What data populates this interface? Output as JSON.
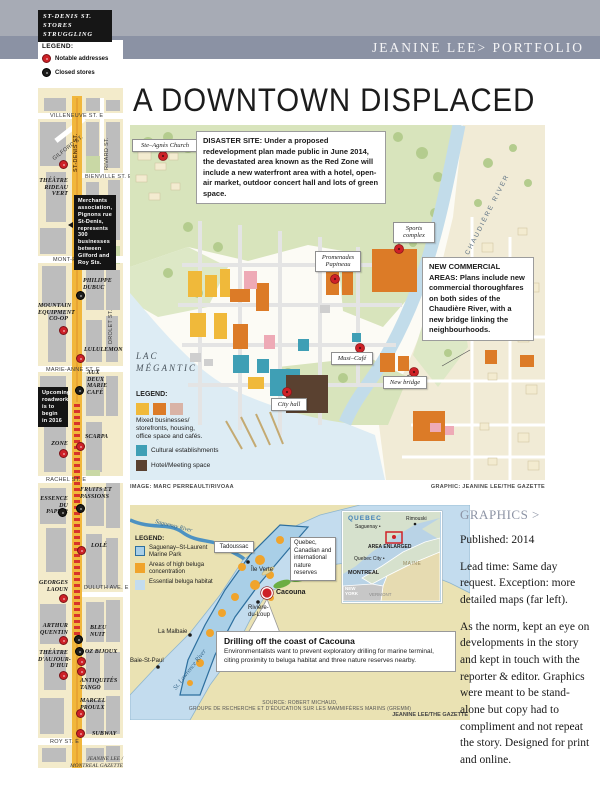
{
  "header": {
    "portfolio_label": "JEANINE LEE> PORTFOLIO",
    "page_title": "A DOWNTOWN DISPLACED"
  },
  "sidebar": {
    "title": "ST-DENIS ST.\nSTORES\nSTRUGGLING",
    "legend": {
      "heading": "LEGEND:",
      "notable": "Notable addresses",
      "closed": "Closed stores",
      "notable_color": "#ce2127",
      "closed_color": "#1d1d1b"
    },
    "streets": {
      "villeneuve": "VILLENEUVE ST. E",
      "gilford": "GILFORD ST.",
      "stdenis": "ST-DENIS ST.",
      "rivard": "RIVARD ST.",
      "bienville": "BIENVILLE ST. E",
      "montroyal": "MONT-ROYAL AVE. E",
      "drolet": "DROLET ST.",
      "marieanne": "MARIE-ANNE ST. E",
      "rachel": "RACHEL ST. E",
      "duluth": "DULUTH AVE. E",
      "roy": "ROY ST. E"
    },
    "notes": {
      "merchants": "Merchants association, Pignons rue St-Denis, represents 300 businesses between Gilford and Roy Sts.",
      "roadwork": "Upcoming roadwork is to begin in 2016"
    },
    "stores": [
      {
        "label": "THÉÂTRE\nRIDEAU\nVERT",
        "type": "red"
      },
      {
        "label": "PHILIPPE\nDUBUC",
        "type": "black"
      },
      {
        "label": "MOUNTAIN\nEQUIPMENT\nCO-OP",
        "type": "red"
      },
      {
        "label": "LULULEMON",
        "type": "red"
      },
      {
        "label": "AUX\nDEUX\nMARIE\nCAFÉ",
        "type": "black"
      },
      {
        "label": "SCARPA",
        "type": "red"
      },
      {
        "label": "ZONE",
        "type": "red"
      },
      {
        "label": "FRUITS ET\nPASSIONS",
        "type": "black"
      },
      {
        "label": "ESSENCE\nDU PAPIER",
        "type": "black"
      },
      {
        "label": "LOLÉ",
        "type": "red"
      },
      {
        "label": "GEORGES\nLAOUN",
        "type": "red"
      },
      {
        "label": "ARTHUR\nQUENTIN",
        "type": "red"
      },
      {
        "label": "BLEU\nNUIT",
        "type": "black"
      },
      {
        "label": "OZ BIJOUX",
        "type": "black"
      },
      {
        "label": "L'EXPRESS",
        "type": "red"
      },
      {
        "label": "THÉÂTRE\nD'AUJOUR-\nD'HUI",
        "type": "red"
      },
      {
        "label": "ANTIQUITÉS\nTANGO",
        "type": "red"
      },
      {
        "label": "MARCEL\nPROULX",
        "type": "red"
      },
      {
        "label": "SUBWAY",
        "type": "red"
      }
    ],
    "credit": "JEANINE LEE /\nMONTREAL GAZETTE"
  },
  "main_map": {
    "callouts": {
      "disaster": "DISASTER SITE: Under a proposed redevelopment plan made public in June 2014, the devastated area known as the Red Zone will include a new waterfront area with a hotel, open-air market, outdoor concert hall and lots of green space.",
      "commercial": "NEW COMMERCIAL AREAS: Plans include new commercial thoroughfares on both sides of the Chaudière River, with a new bridge linking the neighbourhoods."
    },
    "labels": {
      "church": "Ste–Agnès Church",
      "sports": "Sports\ncomplex",
      "promenades": "Promenades\nPapineau",
      "musicafe": "Musi–Café",
      "newbridge": "New bridge",
      "cityhall": "City hall",
      "river": "CHAUDIÈRE RIVER",
      "lake": "LAC\nMÉGANTIC"
    },
    "legend": {
      "heading": "LEGEND:",
      "mixed": "Mixed businesses/\nstorefronts, housing,\noffice space and cafés.",
      "cultural": "Cultural establishments",
      "hotel": "Hotel/Meeting space",
      "yellow": "#f0b93a",
      "orange": "#dc7b27",
      "pink": "#d9b3a6",
      "teal": "#3f9fb5",
      "brown": "#5a4130"
    },
    "credit_image": "IMAGE: MARC PERREAULT/RIVOAA",
    "credit_graphic": "GRAPHIC: JEANINE LEE/THE GAZETTE"
  },
  "small_map": {
    "legend": {
      "heading": "LEGEND:",
      "park": "Saguenay–St-Laurent\nMarine Park",
      "beluga": "Areas of high beluga concentration",
      "habitat": "Essential beluga habitat",
      "park_color": "#a9cfe7",
      "beluga_color": "#f0a42c",
      "habitat_color": "#c3dcee"
    },
    "labels": {
      "saguenay_river": "Saguenay River",
      "tadoussac": "Tadoussac",
      "ile_verte": "Île Verte",
      "cacouna": "Cacouna",
      "riviere_du_loup": "Rivière-\ndu-Loup",
      "la_malbaie": "La Malbaie",
      "baie_st_paul": "Baie-St-Paul",
      "kamouraska": "Kamouraska",
      "st_lawrence": "St. Lawrence River"
    },
    "reserves_note": "Quebec, Canadian and international nature reserves",
    "callout": {
      "heading": "Drilling off the coast of Cacouna",
      "body": "Environmentalists want to prevent exploratory drilling for marine terminal, citing proximity to beluga habitat and three nature reserves nearby."
    },
    "source": "SOURCE: ROBERT MICHAUD,\nGROUPE DE RECHERCHE ET D'ÉDUCATION SUR LES MAMMIFÈRES MARINS (GREMM)",
    "credit": "JEANINE LEE/THE GAZETTE",
    "inset": {
      "region": "QUEBEC",
      "saguenay": "Saguenay •",
      "rimouski": "Rimouski",
      "area_enlarged": "AREA ENLARGED",
      "quebec_city": "Quebec City •",
      "montreal": "MONTREAL",
      "maine": "MAINE",
      "new_york": "NEW\nYORK",
      "vermont": "VERMONT"
    }
  },
  "right_column": {
    "heading": "GRAPHICS >",
    "published": "Published: 2014",
    "para1": "Lead time: Same day request. Exception: more detailed maps (far left).",
    "para2": "As the norm, kept an eye on developments in the story and kept in touch with the reporter & editor. Graphics were meant to be stand-alone but copy had to compliment and not repeat the story. Designed for print and online."
  }
}
